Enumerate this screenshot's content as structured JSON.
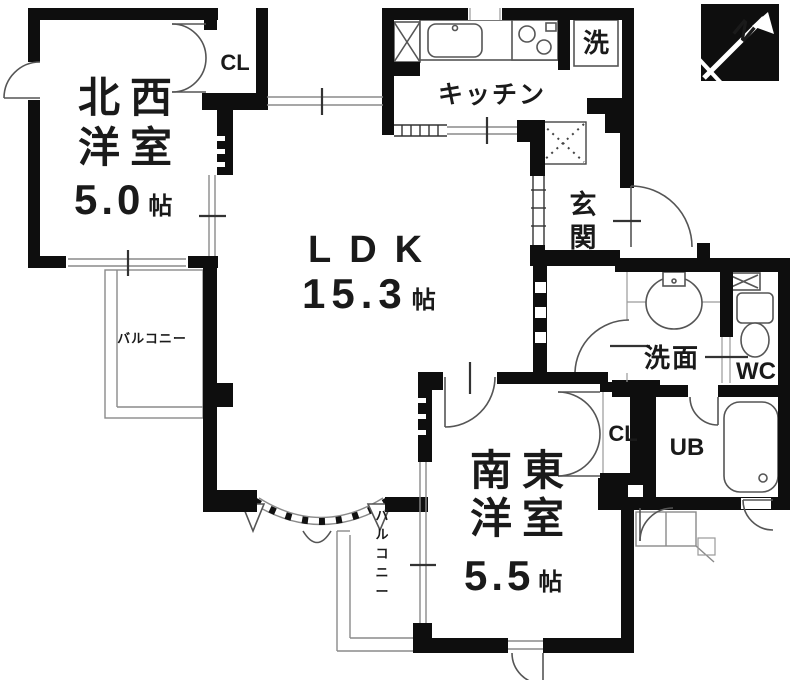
{
  "floorplan": {
    "rooms": {
      "northwest_room": {
        "line1": "北西",
        "line2": "洋室",
        "size": "5.0",
        "size_unit": "帖"
      },
      "ldk": {
        "name": "LDK",
        "size": "15.3",
        "size_unit": "帖"
      },
      "southeast_room": {
        "line1": "南東",
        "line2": "洋室",
        "size": "5.5",
        "size_unit": "帖"
      },
      "kitchen": {
        "name": "キッチン"
      },
      "entrance": {
        "name": "玄関"
      },
      "washroom": {
        "name": "洗面"
      },
      "toilet": {
        "name": "WC"
      },
      "unit_bath": {
        "name": "UB"
      },
      "laundry": {
        "name": "洗"
      },
      "closet_northwest": {
        "name": "CL"
      },
      "closet_southeast": {
        "name": "CL"
      },
      "balcony_west": {
        "name": "バルコニー"
      },
      "balcony_south": {
        "name": "バルコニー"
      }
    },
    "compass": {
      "label": "N"
    },
    "colors": {
      "wall": "#0e0e0e",
      "line_gray": "#8a8a8a",
      "door_arc": "#555555",
      "text": "#1a1a1a",
      "background": "#ffffff"
    }
  }
}
